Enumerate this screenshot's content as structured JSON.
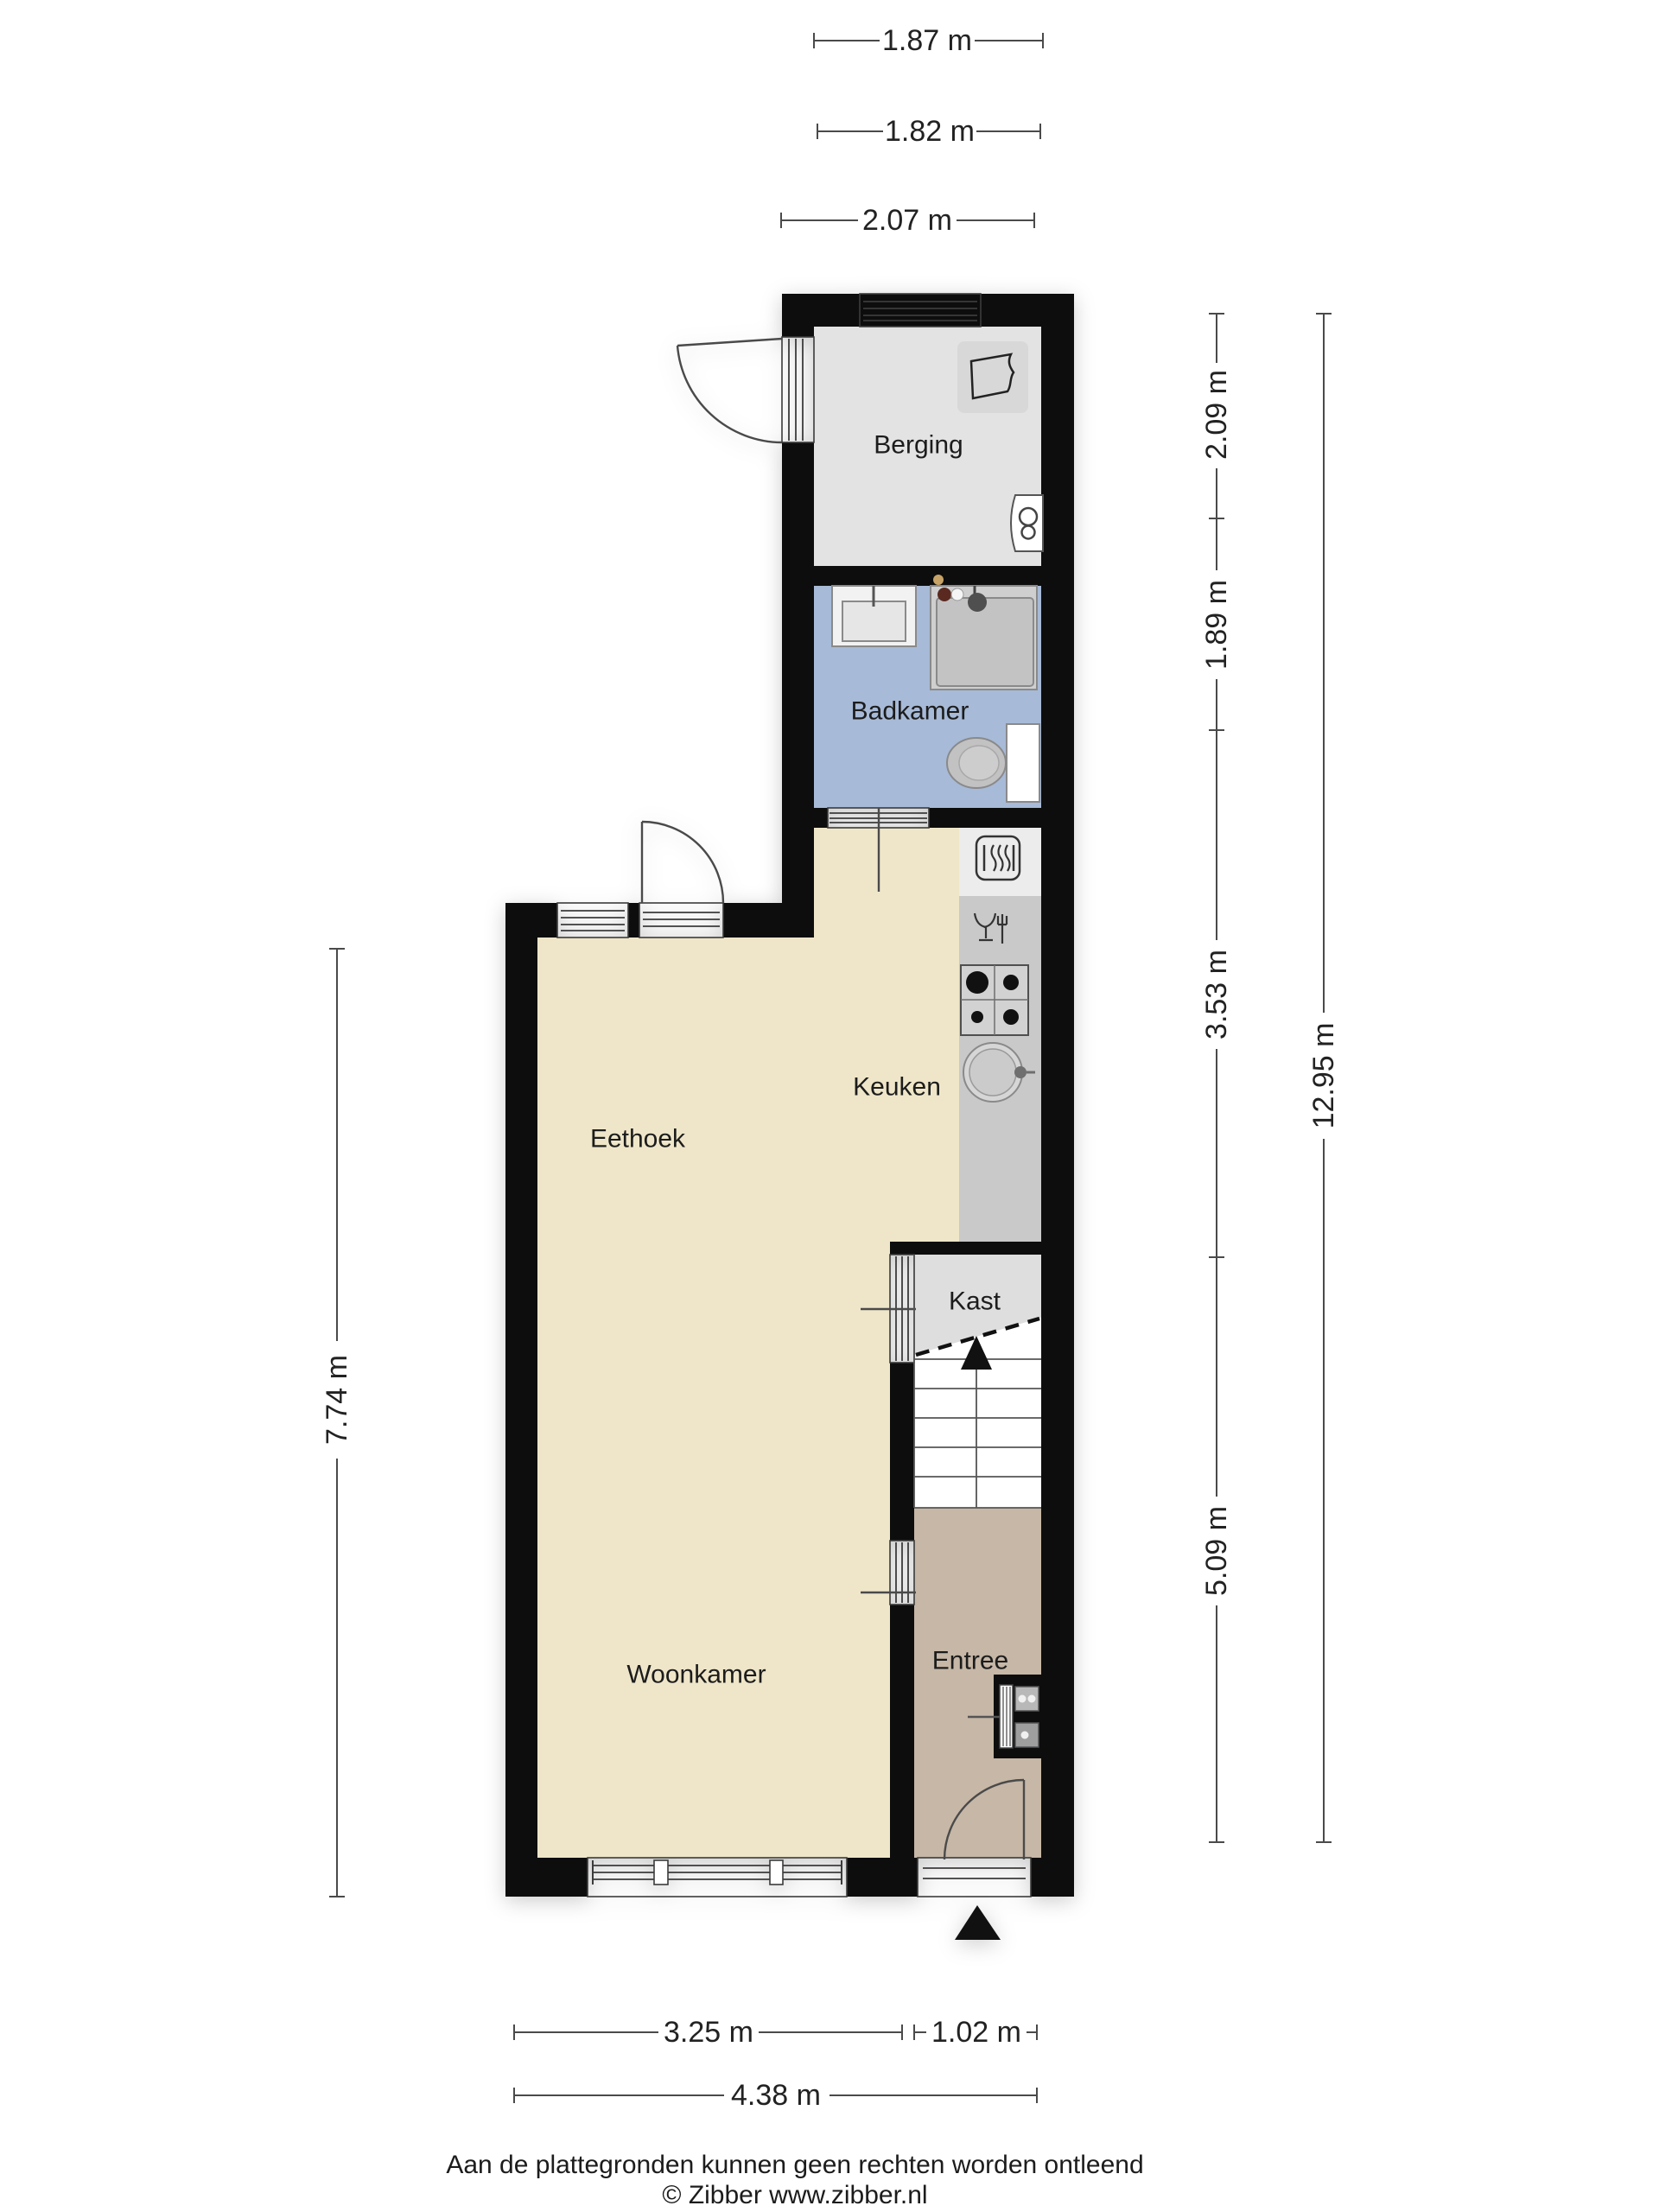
{
  "floorplan": {
    "rooms": [
      {
        "id": "berging",
        "label": "Berging"
      },
      {
        "id": "badkamer",
        "label": "Badkamer"
      },
      {
        "id": "keuken",
        "label": "Keuken"
      },
      {
        "id": "eethoek",
        "label": "Eethoek"
      },
      {
        "id": "woonkamer",
        "label": "Woonkamer"
      },
      {
        "id": "kast",
        "label": "Kast"
      },
      {
        "id": "entree",
        "label": "Entree"
      }
    ],
    "dimensions": {
      "top": [
        "1.87 m",
        "1.82 m",
        "2.07 m"
      ],
      "right_segments": [
        "2.09 m",
        "1.89 m",
        "3.53 m",
        "5.09 m"
      ],
      "right_total": "12.95 m",
      "left": "7.74 m",
      "bottom_segments": [
        "3.25 m",
        "1.02 m"
      ],
      "bottom_total": "4.38 m"
    },
    "icons": [
      "window",
      "door-swing",
      "laundry-basket",
      "boiler",
      "washbasin",
      "shower",
      "toilet",
      "heater",
      "dishwasher",
      "stove-4-burner",
      "round-sink",
      "stairs-up-arrow",
      "meter-cupboard",
      "entrance-arrow"
    ],
    "colors": {
      "wall": "#0d0d0d",
      "berging_floor": "#e3e3e3",
      "badkamer_floor": "#a7bad7",
      "living_floor": "#efe6c9",
      "entree_floor": "#c6b7a6",
      "kast_floor": "#dedede",
      "counter": "#c9c9c9",
      "counter_top": "#ececec",
      "stairs": "#ffffff",
      "dimension_line": "#4a4a4a",
      "label_text": "#1c1c1c"
    },
    "footer": {
      "disclaimer": "Aan de plattegronden kunnen geen rechten worden ontleend",
      "credit": "© Zibber www.zibber.nl"
    }
  }
}
